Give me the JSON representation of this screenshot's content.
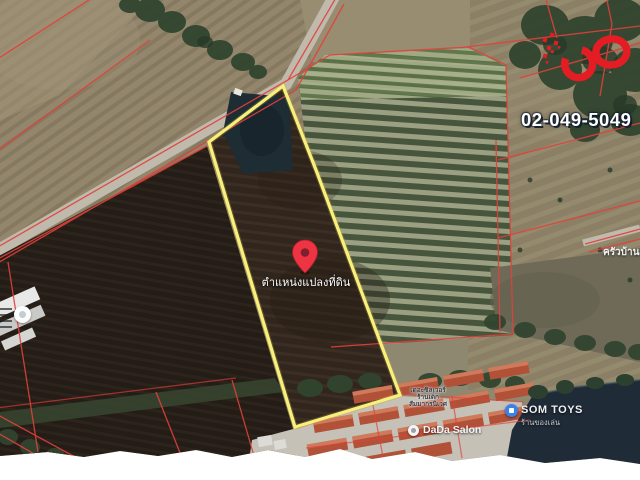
{
  "overlay": {
    "phone": "02-049-5049",
    "logo": {
      "name": "infinity-logo",
      "color": "#e41d24"
    }
  },
  "map": {
    "pin": {
      "label": "ตำแหน่งแปลงที่ดิน",
      "color": "#ee3342"
    },
    "boundary_color": "#f8ef7d",
    "cadastral_color": "#e2413b",
    "pois": [
      {
        "id": "som-toys",
        "title": "SOM TOYS",
        "subtitle": "ร้านของเล่น"
      },
      {
        "id": "dada-salon",
        "title": "DaDa Salon"
      },
      {
        "id": "krua-baan",
        "title": "ครัวบ้าน"
      },
      {
        "id": "village-label",
        "lines": [
          "เดอะซิลเวอร์",
          "ร้านเด็ก",
          "สัมมากรนิเวศ"
        ]
      }
    ]
  }
}
